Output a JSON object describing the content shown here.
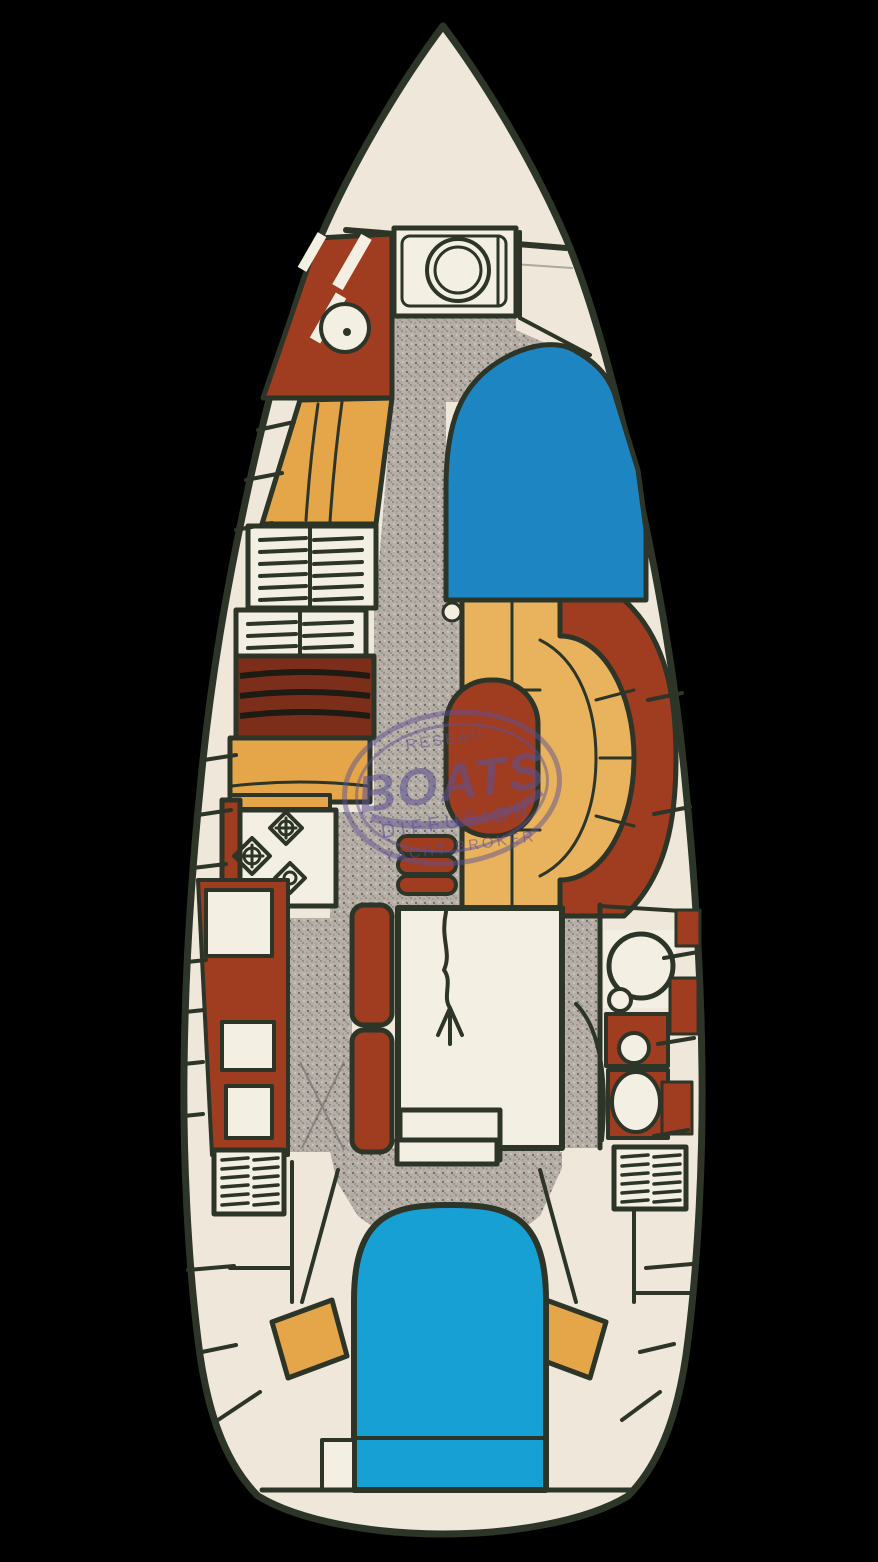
{
  "figure": {
    "kind": "sailboat interior deck plan (scanned brochure drawing)"
  },
  "watermark": {
    "line1": "RESEAU",
    "line2": "BOATS",
    "line3": "DIFFUSION",
    "line4": "YACHT BROKER"
  },
  "palette": {
    "background": "#000000",
    "deck": "#efe8da",
    "outline": "#2c3527",
    "wood": "#a03c20",
    "wood_dark": "#7d2e1a",
    "cushion": "#e4a648",
    "cushion_light": "#e9b35e",
    "berth_fwd": "#1d86c2",
    "berth_aft": "#17a0d4",
    "floor": "#b6afa8",
    "floor_speck": "#6e6862",
    "white": "#f4efe3",
    "watermark": "#5d5192"
  }
}
